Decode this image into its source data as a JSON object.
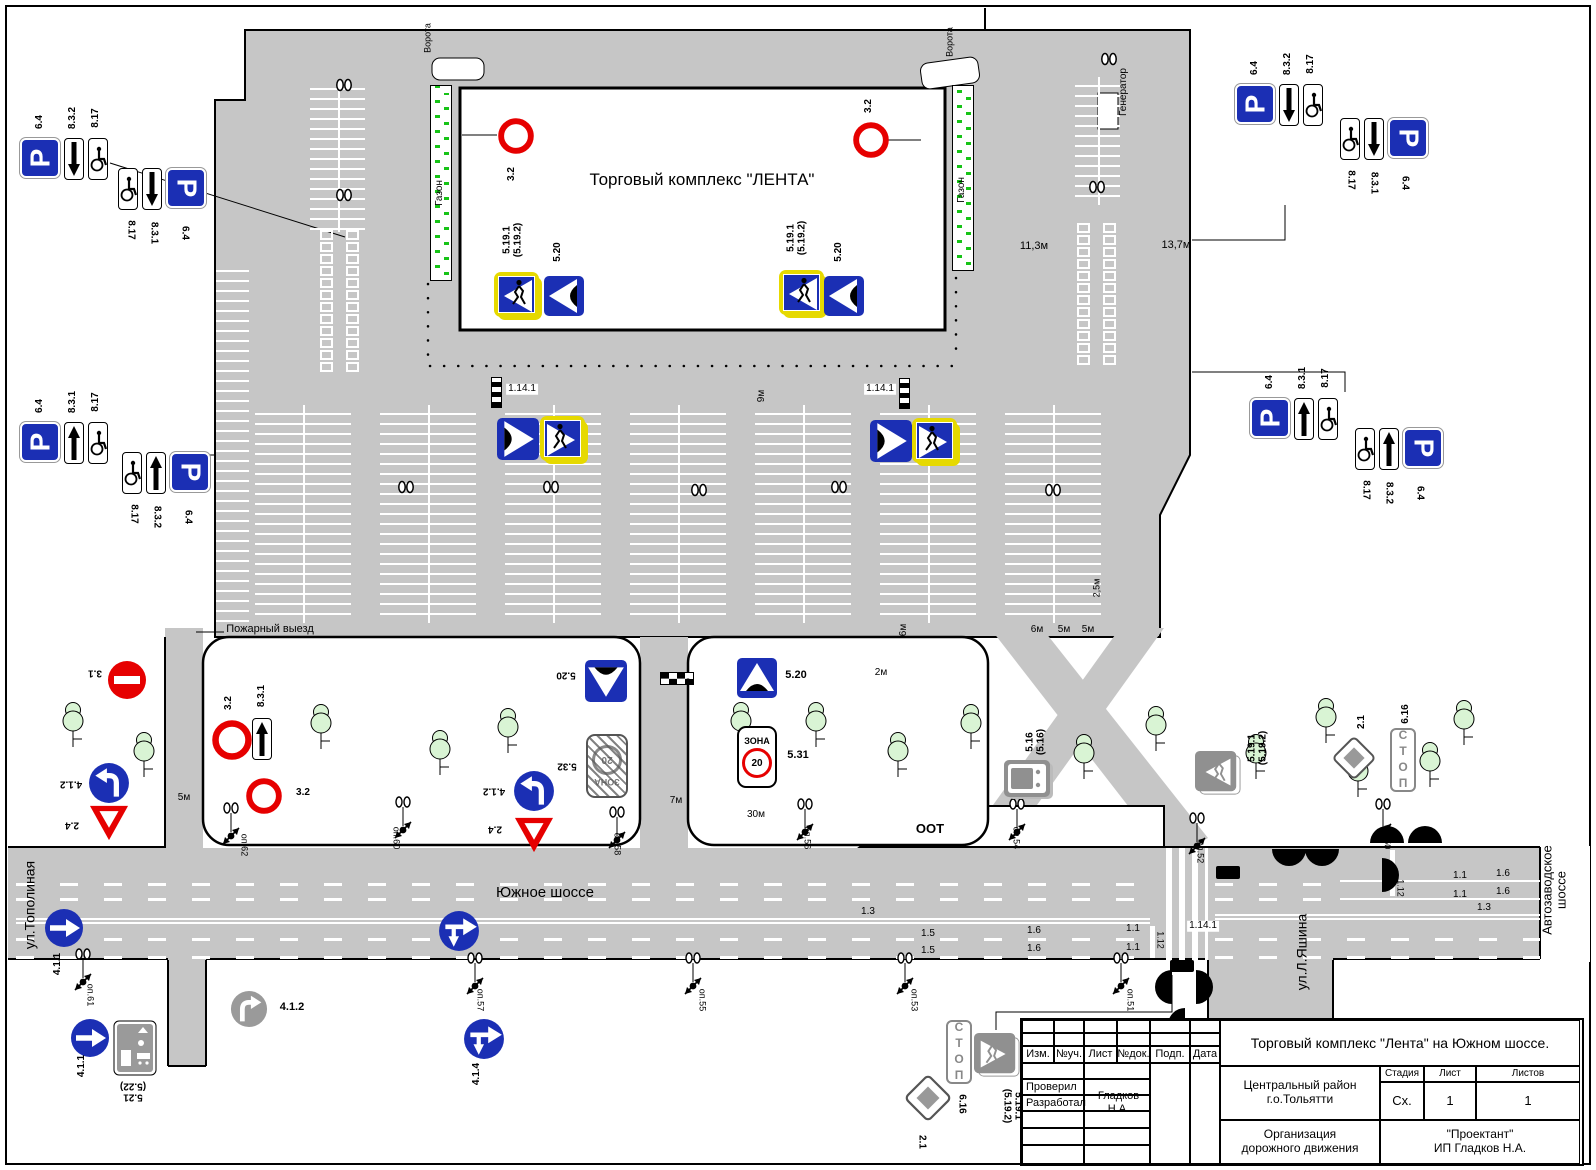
{
  "colors": {
    "blue": "#1b2fb4",
    "red": "#e60000",
    "yellow": "#e6d900",
    "gray_sign": "#909090",
    "road": "#c6c6c6",
    "tree": "#d9f4d4",
    "hatch_green": "#17c317"
  },
  "glyphs": {
    "parking": "P",
    "stop_text": "СТОП",
    "zone_word": "ЗОНА",
    "zone_speed": "20"
  },
  "building": {
    "label": "Торговый комплекс \"ЛЕНТА\""
  },
  "texts": [
    [
      "ул.Тополиная",
      30,
      905,
      -90,
      14,
      0,
      0
    ],
    [
      "ул.Л.Яшина",
      1302,
      952,
      -90,
      14,
      0,
      0
    ],
    [
      "Автозаводское шоссе",
      1554,
      890,
      -90,
      13,
      0,
      0
    ],
    [
      "Южное шоссе",
      545,
      893,
      0,
      15,
      0,
      0
    ],
    [
      "Пожарный выезд",
      270,
      630,
      0,
      11,
      0,
      0
    ],
    [
      "ООТ",
      930,
      829,
      0,
      13,
      1,
      0
    ],
    [
      "Газон",
      440,
      193,
      -90,
      10,
      0,
      0
    ],
    [
      "Газон",
      962,
      190,
      -90,
      10,
      0,
      0
    ],
    [
      "Ворота",
      428,
      38,
      -90,
      9,
      0,
      0
    ],
    [
      "Ворота",
      950,
      42,
      -90,
      9,
      0,
      0
    ],
    [
      "Генератор",
      1124,
      92,
      -90,
      10,
      0,
      0
    ],
    [
      "11,3м",
      1034,
      247,
      0,
      11,
      0,
      0
    ],
    [
      "13,7м",
      1176,
      246,
      0,
      11,
      0,
      0
    ],
    [
      "9м",
      762,
      396,
      -90,
      10,
      0,
      0
    ],
    [
      "6м",
      904,
      630,
      -90,
      10,
      0,
      0
    ],
    [
      "6м",
      1037,
      630,
      0,
      10,
      0,
      0
    ],
    [
      "5м",
      1064,
      630,
      0,
      10,
      0,
      0
    ],
    [
      "5м",
      1088,
      630,
      0,
      10,
      0,
      0
    ],
    [
      "2,5м",
      1097,
      588,
      -90,
      9,
      0,
      0
    ],
    [
      "2м",
      881,
      673,
      0,
      10,
      0,
      0
    ],
    [
      "7м",
      676,
      801,
      0,
      10,
      0,
      0
    ],
    [
      "30м",
      756,
      815,
      0,
      10,
      0,
      0
    ],
    [
      "5м",
      184,
      798,
      0,
      10,
      0,
      0
    ],
    [
      "1.14.1",
      522,
      389,
      0,
      10,
      0,
      1
    ],
    [
      "1.14.1",
      880,
      389,
      0,
      10,
      0,
      1
    ],
    [
      "1.14.1",
      1203,
      926,
      0,
      10,
      0,
      1
    ],
    [
      "1.3",
      868,
      912,
      0,
      10,
      0,
      0
    ],
    [
      "1.5",
      928,
      934,
      0,
      10,
      0,
      0
    ],
    [
      "1.5",
      928,
      951,
      0,
      10,
      0,
      0
    ],
    [
      "1.6",
      1034,
      931,
      0,
      10,
      0,
      0
    ],
    [
      "1.6",
      1034,
      949,
      0,
      10,
      0,
      0
    ],
    [
      "1.1",
      1133,
      929,
      0,
      10,
      0,
      0
    ],
    [
      "1.1",
      1133,
      948,
      0,
      10,
      0,
      0
    ],
    [
      "1.12",
      1160,
      940,
      90,
      9,
      0,
      0
    ],
    [
      "1.1",
      1460,
      876,
      0,
      10,
      0,
      0
    ],
    [
      "1.1",
      1460,
      895,
      0,
      10,
      0,
      0
    ],
    [
      "1.6",
      1503,
      874,
      0,
      10,
      0,
      0
    ],
    [
      "1.6",
      1503,
      892,
      0,
      10,
      0,
      0
    ],
    [
      "1.12",
      1400,
      888,
      90,
      9,
      0,
      0
    ],
    [
      "1.3",
      1484,
      908,
      0,
      10,
      0,
      0
    ],
    [
      "оп.62",
      244,
      845,
      90,
      9,
      0,
      0
    ],
    [
      "оп.60",
      396,
      838,
      90,
      9,
      0,
      0
    ],
    [
      "оп.58",
      617,
      844,
      90,
      9,
      0,
      0
    ],
    [
      "оп.56",
      807,
      838,
      90,
      9,
      0,
      0
    ],
    [
      "оп.54",
      1016,
      838,
      90,
      9,
      0,
      0
    ],
    [
      "оп.52",
      1200,
      852,
      90,
      9,
      0,
      0
    ],
    [
      "оп.50",
      1387,
      838,
      90,
      9,
      0,
      0
    ],
    [
      "оп.61",
      90,
      995,
      90,
      9,
      0,
      0
    ],
    [
      "оп.57",
      480,
      1000,
      90,
      9,
      0,
      0
    ],
    [
      "оп.55",
      702,
      1000,
      90,
      9,
      0,
      0
    ],
    [
      "оп.53",
      914,
      1000,
      90,
      9,
      0,
      0
    ],
    [
      "оп.51",
      1130,
      1000,
      90,
      9,
      0,
      0
    ],
    [
      "6.4",
      40,
      122,
      -90,
      10,
      1,
      0
    ],
    [
      "8.3.2",
      73,
      118,
      -90,
      10,
      1,
      0
    ],
    [
      "8.17",
      96,
      118,
      -90,
      10,
      1,
      0
    ],
    [
      "8.17",
      130,
      230,
      90,
      10,
      1,
      0
    ],
    [
      "8.3.1",
      153,
      233,
      90,
      10,
      1,
      0
    ],
    [
      "6.4",
      184,
      233,
      90,
      10,
      1,
      0
    ],
    [
      "6.4",
      40,
      406,
      -90,
      10,
      1,
      0
    ],
    [
      "8.3.1",
      73,
      402,
      -90,
      10,
      1,
      0
    ],
    [
      "8.17",
      96,
      402,
      -90,
      10,
      1,
      0
    ],
    [
      "8.17",
      133,
      514,
      90,
      10,
      1,
      0
    ],
    [
      "8.3.2",
      156,
      517,
      90,
      10,
      1,
      0
    ],
    [
      "6.4",
      187,
      517,
      90,
      10,
      1,
      0
    ],
    [
      "6.4",
      1255,
      68,
      -90,
      10,
      1,
      0
    ],
    [
      "8.3.2",
      1288,
      64,
      -90,
      10,
      1,
      0
    ],
    [
      "8.17",
      1311,
      64,
      -90,
      10,
      1,
      0
    ],
    [
      "8.17",
      1350,
      180,
      90,
      10,
      1,
      0
    ],
    [
      "8.3.1",
      1373,
      183,
      90,
      10,
      1,
      0
    ],
    [
      "6.4",
      1404,
      183,
      90,
      10,
      1,
      0
    ],
    [
      "6.4",
      1270,
      382,
      -90,
      10,
      1,
      0
    ],
    [
      "8.3.1",
      1303,
      378,
      -90,
      10,
      1,
      0
    ],
    [
      "8.17",
      1326,
      378,
      -90,
      10,
      1,
      0
    ],
    [
      "8.17",
      1365,
      490,
      90,
      10,
      1,
      0
    ],
    [
      "8.3.2",
      1388,
      493,
      90,
      10,
      1,
      0
    ],
    [
      "6.4",
      1419,
      493,
      90,
      10,
      1,
      0
    ],
    [
      "3.2",
      512,
      174,
      -90,
      10,
      1,
      0
    ],
    [
      "3.2",
      869,
      106,
      -90,
      10,
      1,
      0
    ],
    [
      "5.19.1\n(5.19.2)",
      513,
      240,
      -90,
      10,
      1,
      0
    ],
    [
      "5.20",
      558,
      252,
      -90,
      10,
      1,
      0
    ],
    [
      "5.19.1\n(5.19.2)",
      797,
      238,
      -90,
      10,
      1,
      0
    ],
    [
      "5.20",
      839,
      252,
      -90,
      10,
      1,
      0
    ],
    [
      "3.1",
      95,
      672,
      180,
      10,
      1,
      0
    ],
    [
      "4.1.2",
      71,
      783,
      180,
      10,
      1,
      0
    ],
    [
      "2.4",
      72,
      824,
      180,
      10,
      1,
      0
    ],
    [
      "3.2",
      229,
      703,
      -90,
      10,
      1,
      0
    ],
    [
      "8.3.1",
      262,
      696,
      -90,
      10,
      1,
      0
    ],
    [
      "3.2",
      303,
      793,
      0,
      10,
      1,
      0
    ],
    [
      "5.20",
      566,
      674,
      180,
      10,
      1,
      0
    ],
    [
      "5.32",
      567,
      765,
      180,
      10,
      1,
      0
    ],
    [
      "4.1.2",
      494,
      790,
      180,
      10,
      1,
      0
    ],
    [
      "2.4",
      495,
      828,
      180,
      10,
      1,
      0
    ],
    [
      "5.20",
      796,
      676,
      0,
      11,
      1,
      0
    ],
    [
      "5.31",
      798,
      756,
      0,
      11,
      1,
      0
    ],
    [
      "5.16\n(5.16)",
      1036,
      742,
      -90,
      10,
      1,
      0
    ],
    [
      "5.19.1\n(5.19.2)",
      1258,
      748,
      -90,
      10,
      1,
      0
    ],
    [
      "2.1",
      1362,
      722,
      -90,
      10,
      1,
      0
    ],
    [
      "6.16",
      1406,
      714,
      -90,
      10,
      1,
      0
    ],
    [
      "4.1.1",
      58,
      964,
      -90,
      10,
      1,
      0
    ],
    [
      "4.1.1",
      82,
      1066,
      -90,
      10,
      1,
      0
    ],
    [
      "5.21\n(5.22)",
      133,
      1091,
      180,
      10,
      1,
      0
    ],
    [
      "4.1.2",
      292,
      1008,
      0,
      11,
      1,
      0
    ],
    [
      "4.1.4",
      477,
      1074,
      -90,
      10,
      1,
      0
    ],
    [
      "2.1",
      921,
      1142,
      90,
      10,
      1,
      0
    ],
    [
      "6.16",
      961,
      1104,
      90,
      10,
      1,
      0
    ],
    [
      "5.19.1\n(5.19.2)",
      1012,
      1106,
      90,
      10,
      1,
      0
    ]
  ],
  "signs": [
    {
      "k": "p",
      "x": 20,
      "y": 138,
      "pr": -90
    },
    {
      "k": "pd",
      "x": 64,
      "y": 138
    },
    {
      "k": "wc",
      "x": 88,
      "y": 138
    },
    {
      "k": "wc",
      "x": 118,
      "y": 168
    },
    {
      "k": "pd",
      "x": 142,
      "y": 168
    },
    {
      "k": "p",
      "x": 166,
      "y": 168,
      "pr": 90
    },
    {
      "k": "p",
      "x": 20,
      "y": 422,
      "pr": -90
    },
    {
      "k": "pu",
      "x": 64,
      "y": 422
    },
    {
      "k": "wc",
      "x": 88,
      "y": 422
    },
    {
      "k": "wc",
      "x": 122,
      "y": 452
    },
    {
      "k": "pu",
      "x": 146,
      "y": 452
    },
    {
      "k": "p",
      "x": 170,
      "y": 452,
      "pr": 90
    },
    {
      "k": "p",
      "x": 1235,
      "y": 84,
      "pr": -90
    },
    {
      "k": "pd",
      "x": 1279,
      "y": 84
    },
    {
      "k": "wc",
      "x": 1303,
      "y": 84
    },
    {
      "k": "wc",
      "x": 1340,
      "y": 118
    },
    {
      "k": "pd",
      "x": 1364,
      "y": 118
    },
    {
      "k": "p",
      "x": 1388,
      "y": 118,
      "pr": 90
    },
    {
      "k": "p",
      "x": 1250,
      "y": 398,
      "pr": -90
    },
    {
      "k": "pu",
      "x": 1294,
      "y": 398
    },
    {
      "k": "wc",
      "x": 1318,
      "y": 398
    },
    {
      "k": "wc",
      "x": 1355,
      "y": 428
    },
    {
      "k": "pu",
      "x": 1379,
      "y": 428
    },
    {
      "k": "p",
      "x": 1403,
      "y": 428,
      "pr": 90
    },
    {
      "k": "ne",
      "x": 498,
      "y": 118,
      "s": 36
    },
    {
      "k": "ne",
      "x": 853,
      "y": 122,
      "s": 36
    },
    {
      "k": "pedy",
      "x": 494,
      "y": 272,
      "s": 48,
      "d": "l"
    },
    {
      "k": "bump",
      "x": 544,
      "y": 276,
      "s": 40,
      "r": 270
    },
    {
      "k": "pedy",
      "x": 779,
      "y": 270,
      "s": 48,
      "d": "l"
    },
    {
      "k": "bump",
      "x": 824,
      "y": 276,
      "s": 40,
      "r": 270
    },
    {
      "k": "bump",
      "x": 497,
      "y": 418,
      "s": 42,
      "r": 90
    },
    {
      "k": "pedy",
      "x": 540,
      "y": 416,
      "s": 48,
      "d": "r"
    },
    {
      "k": "bump",
      "x": 870,
      "y": 420,
      "s": 42,
      "r": 90
    },
    {
      "k": "pedy",
      "x": 912,
      "y": 418,
      "s": 48,
      "d": "r"
    },
    {
      "k": "brick",
      "x": 107,
      "y": 660,
      "s": 40
    },
    {
      "k": "tl",
      "x": 88,
      "y": 762,
      "s": 42
    },
    {
      "k": "yield",
      "x": 87,
      "y": 803,
      "s": 44
    },
    {
      "k": "ne",
      "x": 212,
      "y": 720,
      "s": 40
    },
    {
      "k": "pu",
      "x": 252,
      "y": 718
    },
    {
      "k": "ne",
      "x": 246,
      "y": 778,
      "s": 36
    },
    {
      "k": "bump",
      "x": 585,
      "y": 660,
      "s": 42,
      "r": 180
    },
    {
      "k": "zonex",
      "x": 586,
      "y": 734
    },
    {
      "k": "tl",
      "x": 513,
      "y": 770,
      "s": 42
    },
    {
      "k": "yield",
      "x": 512,
      "y": 815,
      "s": 44
    },
    {
      "k": "bump",
      "x": 737,
      "y": 658,
      "s": 40
    },
    {
      "k": "zone",
      "x": 737,
      "y": 726
    },
    {
      "k": "bus",
      "x": 1004,
      "y": 760
    },
    {
      "k": "pedg",
      "x": 1195,
      "y": 750,
      "s": 46,
      "d": "l"
    },
    {
      "k": "dia",
      "x": 1330,
      "y": 734,
      "s": 48
    },
    {
      "k": "stop",
      "x": 1390,
      "y": 728
    },
    {
      "k": "r41",
      "x": 44,
      "y": 908,
      "s": 40
    },
    {
      "k": "r41",
      "x": 70,
      "y": 1018,
      "s": 40
    },
    {
      "k": "liv",
      "x": 113,
      "y": 1020
    },
    {
      "k": "trg",
      "x": 230,
      "y": 990,
      "s": 38
    },
    {
      "k": "a414",
      "x": 438,
      "y": 910,
      "s": 42
    },
    {
      "k": "a414",
      "x": 463,
      "y": 1018,
      "s": 42
    },
    {
      "k": "dia",
      "x": 902,
      "y": 1072,
      "s": 52
    },
    {
      "k": "stop",
      "x": 946,
      "y": 1020
    },
    {
      "k": "pedg",
      "x": 974,
      "y": 1032,
      "s": 46,
      "d": "r"
    }
  ],
  "poles": [
    [
      218,
      802
    ],
    [
      390,
      796
    ],
    [
      604,
      806
    ],
    [
      792,
      798
    ],
    [
      1004,
      798
    ],
    [
      1184,
      812
    ],
    [
      1370,
      798
    ],
    [
      70,
      948
    ],
    [
      462,
      952
    ],
    [
      680,
      952
    ],
    [
      892,
      952
    ],
    [
      1108,
      952
    ]
  ],
  "lamps": [
    [
      333,
      78
    ],
    [
      333,
      188
    ],
    [
      395,
      480
    ],
    [
      540,
      480
    ],
    [
      688,
      483
    ],
    [
      828,
      480
    ],
    [
      1042,
      483
    ],
    [
      1086,
      180
    ],
    [
      1098,
      52
    ]
  ],
  "trees": [
    [
      55,
      700
    ],
    [
      126,
      730
    ],
    [
      303,
      702
    ],
    [
      422,
      728
    ],
    [
      490,
      706
    ],
    [
      723,
      700
    ],
    [
      798,
      700
    ],
    [
      880,
      730
    ],
    [
      953,
      702
    ],
    [
      1066,
      732
    ],
    [
      1138,
      704
    ],
    [
      1238,
      732
    ],
    [
      1308,
      696
    ],
    [
      1340,
      750
    ],
    [
      1412,
      740
    ],
    [
      1446,
      698
    ]
  ],
  "stripe_bands": [
    [
      310,
      80,
      55,
      152,
      1
    ],
    [
      216,
      262,
      33,
      368,
      0
    ],
    [
      1075,
      77,
      45,
      128,
      1
    ],
    [
      255,
      405,
      96,
      218,
      1
    ],
    [
      380,
      405,
      96,
      218,
      1
    ],
    [
      505,
      405,
      96,
      218,
      1
    ],
    [
      630,
      405,
      96,
      218,
      1
    ],
    [
      755,
      405,
      96,
      218,
      1
    ],
    [
      880,
      405,
      96,
      218,
      1
    ],
    [
      1005,
      405,
      96,
      218,
      1
    ]
  ],
  "square_grids": [
    [
      320,
      230,
      12
    ],
    [
      1077,
      223,
      12
    ]
  ],
  "gazon_strips": [
    [
      430,
      85,
      22,
      196
    ],
    [
      952,
      85,
      22,
      186
    ]
  ],
  "dash_rows": [
    [
      16,
      883,
      1134
    ],
    [
      16,
      898,
      1134
    ],
    [
      16,
      938,
      1134
    ],
    [
      16,
      956,
      1134
    ],
    [
      1215,
      883,
      120
    ],
    [
      1215,
      898,
      120
    ],
    [
      1215,
      938,
      325
    ],
    [
      1215,
      956,
      325
    ]
  ],
  "white_lines": [
    [
      16,
      918,
      1134,
      2
    ],
    [
      16,
      922,
      1134,
      2
    ],
    [
      1215,
      914,
      325,
      2
    ],
    [
      1215,
      918,
      325,
      2
    ],
    [
      1340,
      880,
      200,
      2
    ],
    [
      1340,
      898,
      200,
      2
    ],
    [
      1150,
      926,
      5,
      32
    ],
    [
      1390,
      850,
      5,
      46
    ]
  ],
  "zebras": [
    [
      1166,
      848,
      42,
      112
    ]
  ],
  "checkers": [
    [
      660,
      672,
      34,
      13
    ]
  ],
  "cpoles": [
    [
      491,
      377
    ],
    [
      899,
      378
    ]
  ],
  "black_bars": [
    [
      1216,
      866,
      24,
      13
    ],
    [
      1170,
      960,
      24,
      12
    ]
  ],
  "discs": [
    [
      1155,
      970,
      "e"
    ],
    [
      1196,
      970,
      "w"
    ],
    [
      1168,
      1008,
      "e"
    ],
    [
      1190,
      1032,
      "w"
    ],
    [
      1272,
      849,
      "n"
    ],
    [
      1305,
      849,
      "n"
    ],
    [
      1370,
      826,
      "s"
    ],
    [
      1408,
      826,
      "s"
    ],
    [
      1382,
      858,
      "w"
    ]
  ],
  "title_block": {
    "doc_title": "Торговый комплекс \"Лента\" на Южном шоссе.",
    "header_cols": [
      "Изм.",
      "№уч.",
      "Лист",
      "№док.",
      "Подп.",
      "Дата"
    ],
    "row_checked": "Проверил",
    "row_developed": "Разработал",
    "developer_name": "Гладков Н.А.",
    "district": "Центральный район\nг.о.Тольятти",
    "stage_label": "Стадия",
    "sheet_label": "Лист",
    "sheets_label": "Листов",
    "stage": "Сх.",
    "sheet": "1",
    "sheets": "1",
    "org": "Организация\nдорожного движения",
    "company": "\"Проектант\"\nИП Гладков Н.А."
  }
}
